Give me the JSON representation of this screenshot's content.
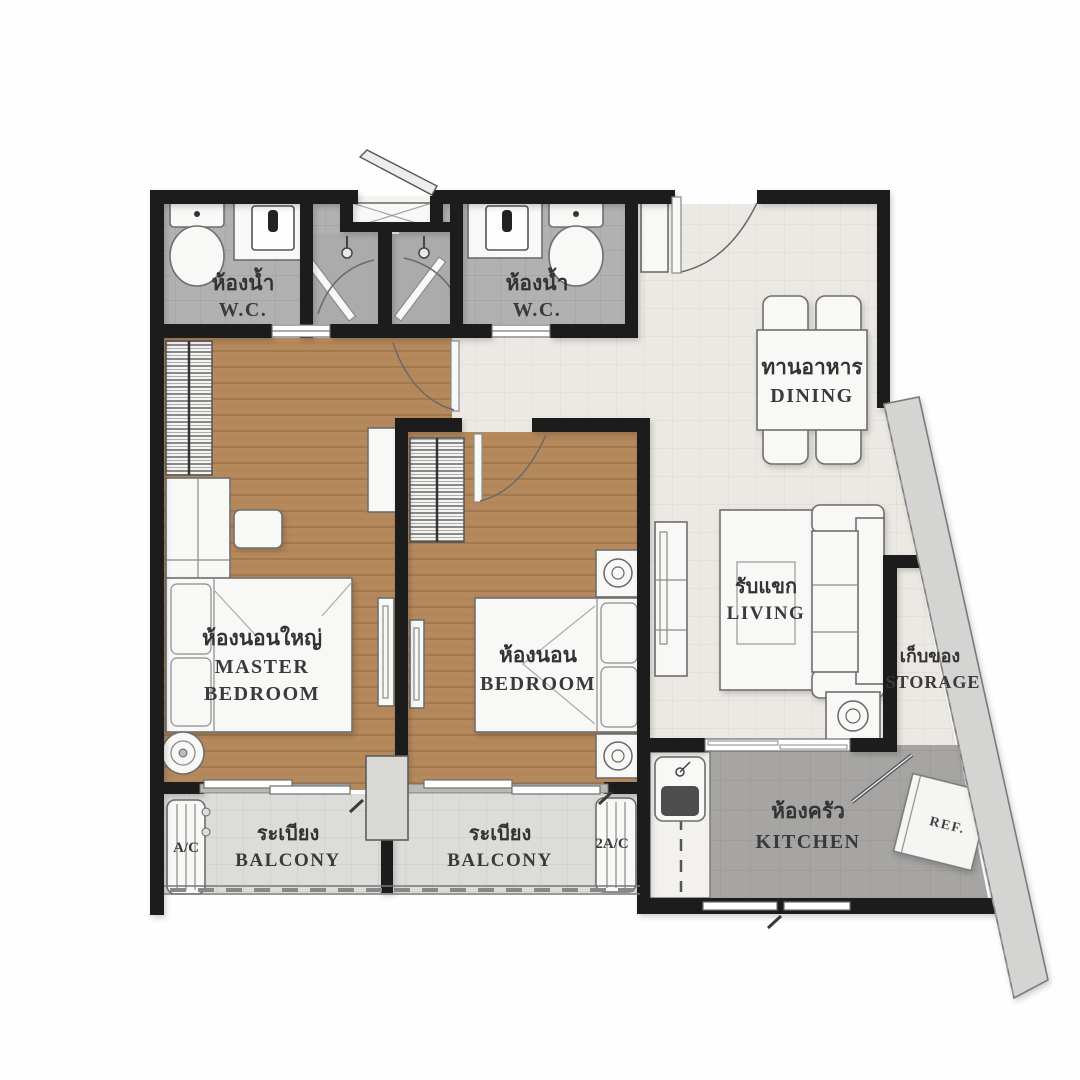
{
  "floorplan": {
    "rooms": {
      "wc1": {
        "th": "ห้องน้ำ",
        "en": "W.C."
      },
      "wc2": {
        "th": "ห้องน้ำ",
        "en": "W.C."
      },
      "dining": {
        "th": "ทานอาหาร",
        "en": "DINING"
      },
      "master_bedroom": {
        "th": "ห้องนอนใหญ่",
        "en_line1": "MASTER",
        "en_line2": "BEDROOM"
      },
      "bedroom": {
        "th": "ห้องนอน",
        "en": "BEDROOM"
      },
      "living": {
        "th": "รับแขก",
        "en": "LIVING"
      },
      "storage": {
        "th": "เก็บของ",
        "en": "STORAGE"
      },
      "kitchen": {
        "th": "ห้องครัว",
        "en": "KITCHEN"
      },
      "balcony1": {
        "th": "ระเบียง",
        "en": "BALCONY"
      },
      "balcony2": {
        "th": "ระเบียง",
        "en": "BALCONY"
      }
    },
    "labels": {
      "fridge": "REF.",
      "ac1": "A/C",
      "ac2": "2A/C"
    },
    "colors": {
      "wall": "#1b1b1b",
      "wood_floor": "#b5895c",
      "bath_tile": "#b1b1b1",
      "kitchen_tile": "#a6a5a3",
      "balcony_tile": "#dcdcd8",
      "hall_tile": "#ece9e4",
      "diagonal_wall": "#d4d4d2",
      "furniture": "#f8f8f6"
    }
  }
}
